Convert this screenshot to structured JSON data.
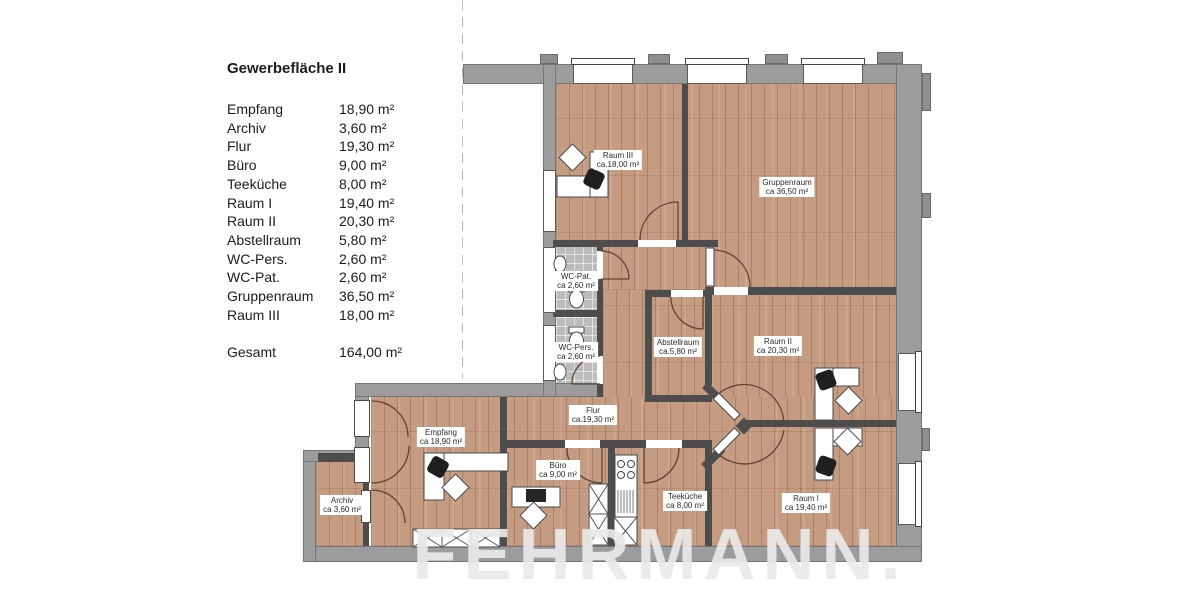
{
  "legend": {
    "title": "Gewerbefläche II",
    "items": [
      {
        "label": "Empfang",
        "area": "18,90 m²"
      },
      {
        "label": "Archiv",
        "area": "3,60 m²"
      },
      {
        "label": "Flur",
        "area": "19,30 m²"
      },
      {
        "label": "Büro",
        "area": "9,00 m²"
      },
      {
        "label": "Teeküche",
        "area": "8,00 m²"
      },
      {
        "label": "Raum I",
        "area": "19,40 m²"
      },
      {
        "label": "Raum II",
        "area": "20,30 m²"
      },
      {
        "label": "Abstellraum",
        "area": "5,80 m²"
      },
      {
        "label": "WC-Pers.",
        "area": "2,60 m²"
      },
      {
        "label": "WC-Pat.",
        "area": "2,60 m²"
      },
      {
        "label": "Gruppenraum",
        "area": "36,50 m²"
      },
      {
        "label": "Raum III",
        "area": "18,00 m²"
      }
    ],
    "total": {
      "label": "Gesamt",
      "area": "164,00 m²"
    }
  },
  "plan": {
    "rooms": [
      {
        "name": "Raum III",
        "area": "ca.18,00 m²"
      },
      {
        "name": "Gruppenraum",
        "area": "ca 36,50 m²"
      },
      {
        "name": "WC-Pat.",
        "area": "ca 2,60 m²"
      },
      {
        "name": "WC-Pers.",
        "area": "ca 2,60 m²"
      },
      {
        "name": "Abstellraum",
        "area": "ca.5,80 m²"
      },
      {
        "name": "Raum II",
        "area": "ca 20,30 m²"
      },
      {
        "name": "Flur",
        "area": "ca.19,30 m²"
      },
      {
        "name": "Empfang",
        "area": "ca 18,90 m²"
      },
      {
        "name": "Büro",
        "area": "ca 9,00 m²"
      },
      {
        "name": "Teeküche",
        "area": "ca 8,00 m²"
      },
      {
        "name": "Raum I",
        "area": "ca 19,40 m²"
      },
      {
        "name": "Archiv",
        "area": "ca 3,60 m²"
      }
    ]
  },
  "watermark": {
    "line1": "FEHRMANN.",
    "line2": "IMMOBILIEN"
  },
  "colors": {
    "wall_outer": "#9c9c9c",
    "wall_inner": "#4d4d4d",
    "wood_floor": "#c59b81",
    "tile_floor": "#bcbcbc",
    "door_arc": "#5d4534"
  }
}
